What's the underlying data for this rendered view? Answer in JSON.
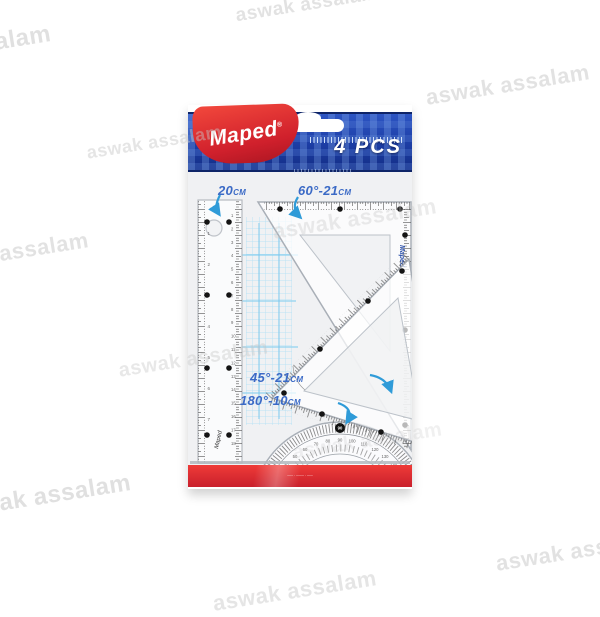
{
  "watermark": {
    "text": "aswak assalam"
  },
  "package": {
    "brand": "Maped",
    "registered": "®",
    "count_badge": "4 PCS",
    "labels": [
      {
        "value": "20",
        "unit": "CM"
      },
      {
        "value": "60°-21",
        "unit": "CM"
      },
      {
        "value": "45°-21",
        "unit": "CM"
      },
      {
        "value": "180°-10",
        "unit": "CM"
      }
    ],
    "fine_print": "––– · –––– · –––",
    "colors": {
      "header_blue": "#2148b2",
      "brand_red": "#d0202c",
      "stripe_red": "#e03238",
      "label_blue": "#3b6ac6"
    }
  },
  "instruments": {
    "ruler": {
      "name": "20cm ruler",
      "left_numbers": [
        1,
        2,
        3,
        4,
        5,
        6,
        7
      ],
      "right_numbers": [
        1,
        2,
        3,
        4,
        5,
        6,
        7,
        8,
        9,
        10,
        11,
        12,
        13,
        14,
        15,
        16,
        17,
        18
      ],
      "brand": "Maped"
    },
    "set_square_60": {
      "name": "60° set square 21cm",
      "brand": "Maped"
    },
    "set_square_45": {
      "name": "45° set square 21cm"
    },
    "protractor": {
      "name": "180° protractor 10cm",
      "top_mark": "90",
      "degrees": [
        10,
        20,
        30,
        40,
        50,
        60,
        70,
        80,
        90,
        100,
        110,
        120,
        130,
        140,
        150,
        160,
        170
      ]
    }
  }
}
